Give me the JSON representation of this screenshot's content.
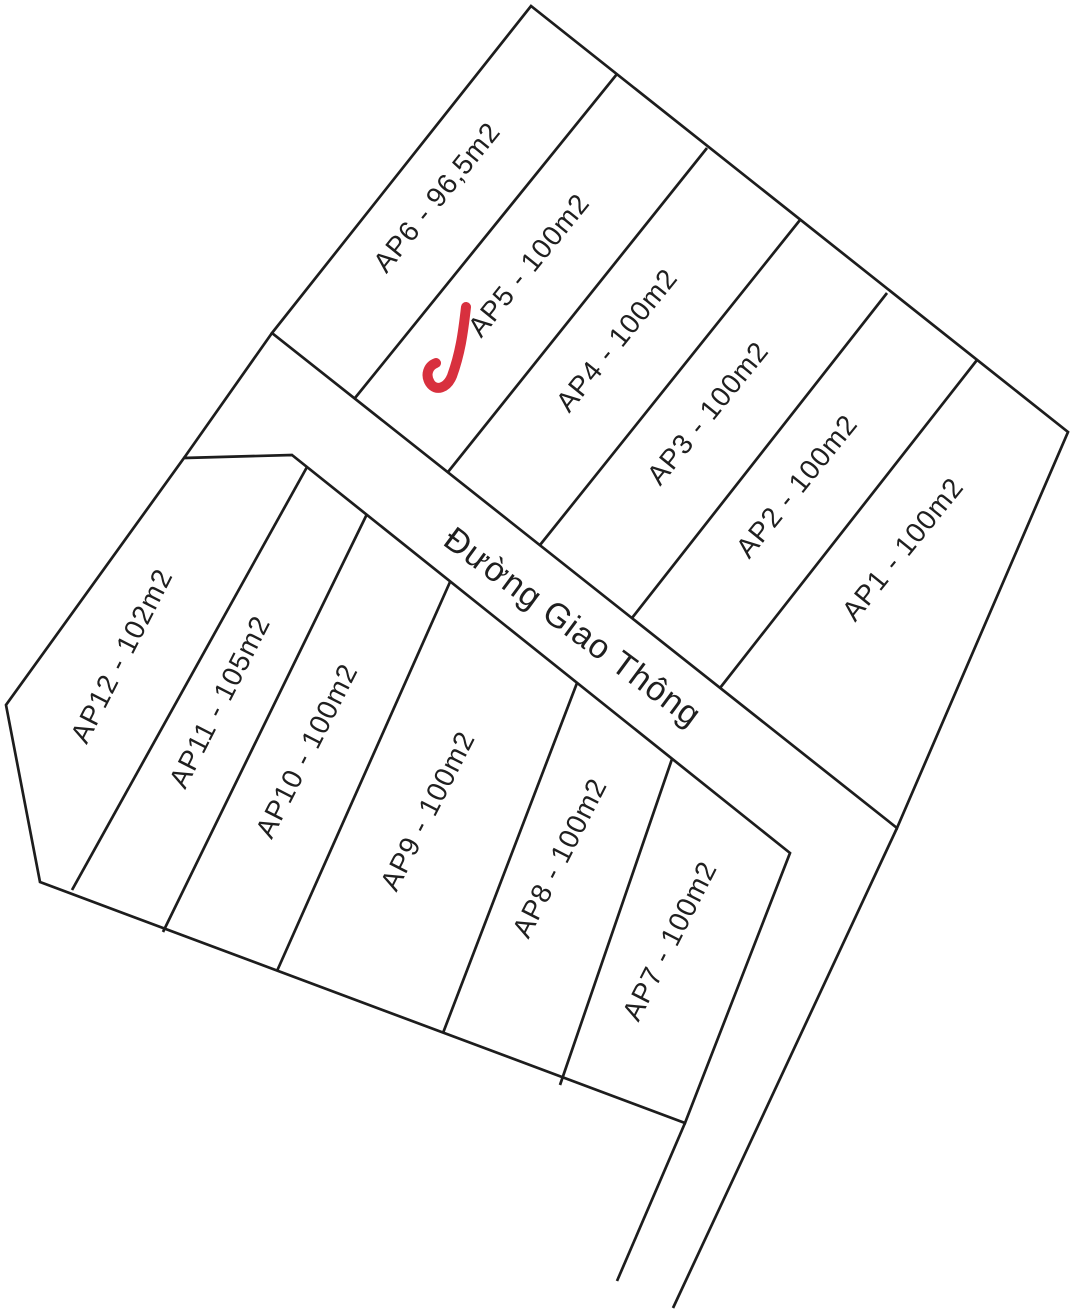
{
  "diagram": {
    "type": "land-plot-subdivision-plan",
    "road": {
      "label": "Đường Giao Thông"
    },
    "blocks": {
      "north": {
        "plots": [
          {
            "id": "AP6",
            "area": "96,5m2",
            "label": "AP6 - 96,5m2"
          },
          {
            "id": "AP5",
            "area": "100m2",
            "label": "AP5 - 100m2",
            "checked": true
          },
          {
            "id": "AP4",
            "area": "100m2",
            "label": "AP4 - 100m2"
          },
          {
            "id": "AP3",
            "area": "100m2",
            "label": "AP3 - 100m2"
          },
          {
            "id": "AP2",
            "area": "100m2",
            "label": "AP2 - 100m2"
          },
          {
            "id": "AP1",
            "area": "100m2",
            "label": "AP1 - 100m2"
          }
        ]
      },
      "south": {
        "plots": [
          {
            "id": "AP12",
            "area": "102m2",
            "label": "AP12 - 102m2"
          },
          {
            "id": "AP11",
            "area": "105m2",
            "label": "AP11 - 105m2"
          },
          {
            "id": "AP10",
            "area": "100m2",
            "label": "AP10 - 100m2"
          },
          {
            "id": "AP9",
            "area": "100m2",
            "label": "AP9 - 100m2"
          },
          {
            "id": "AP8",
            "area": "100m2",
            "label": "AP8 - 100m2"
          },
          {
            "id": "AP7",
            "area": "100m2",
            "label": "AP7 - 100m2"
          }
        ]
      }
    },
    "annotations": {
      "selected_plot": "AP5",
      "checkmark_color": "#d8303e"
    },
    "colors": {
      "line": "#1d1d1d",
      "background": "#ffffff",
      "text": "#1f1f1f"
    }
  }
}
